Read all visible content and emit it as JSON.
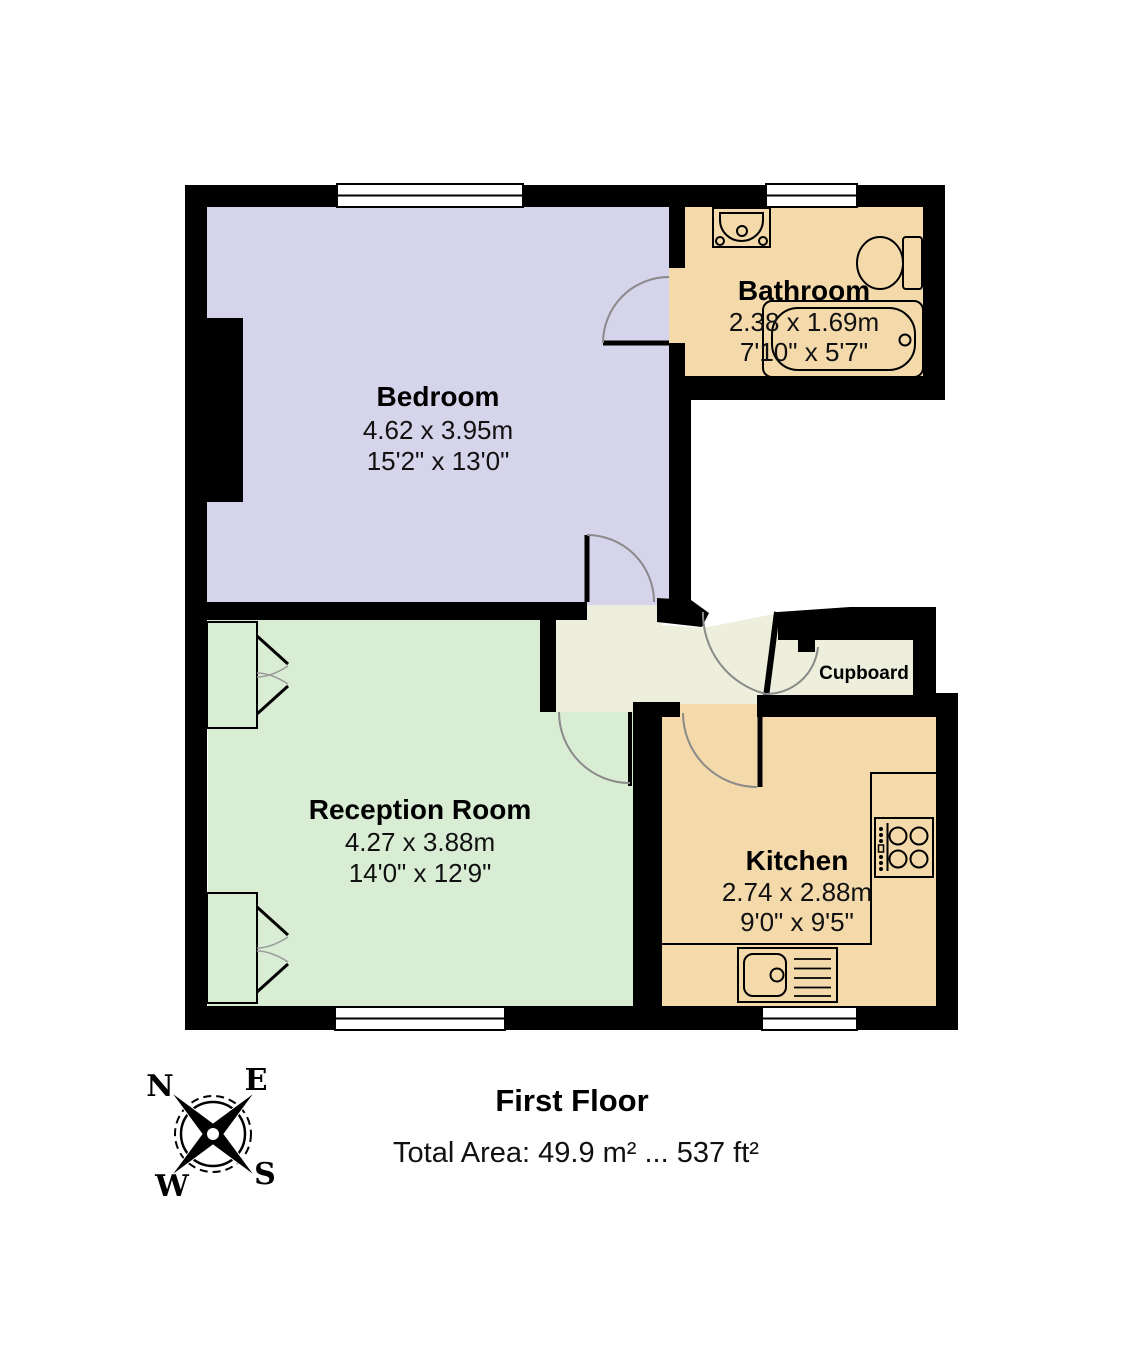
{
  "colors": {
    "wall": "#000000",
    "bedroom": "#d5d4ea",
    "bathroom": "#f4daab",
    "reception": "#d9ecd4",
    "kitchen": "#f4d9ab",
    "hall": "#eeeedd",
    "door_arc": "#8a8a8a"
  },
  "rooms": {
    "bedroom": {
      "name": "Bedroom",
      "metric": "4.62 x 3.95m",
      "imperial": "15'2\" x 13'0\""
    },
    "bathroom": {
      "name": "Bathroom",
      "metric": "2.38 x 1.69m",
      "imperial": "7'10\" x 5'7\""
    },
    "reception": {
      "name": "Reception Room",
      "metric": "4.27 x 3.88m",
      "imperial": "14'0\" x 12'9\""
    },
    "kitchen": {
      "name": "Kitchen",
      "metric": "2.74 x 2.88m",
      "imperial": "9'0\" x 9'5\""
    },
    "cupboard": {
      "name": "Cupboard"
    }
  },
  "compass": {
    "north": "N",
    "east": "E",
    "south": "S",
    "west": "W"
  },
  "footer": {
    "floor_label": "First Floor",
    "total_area": "Total Area: 49.9 m² ... 537 ft²"
  }
}
